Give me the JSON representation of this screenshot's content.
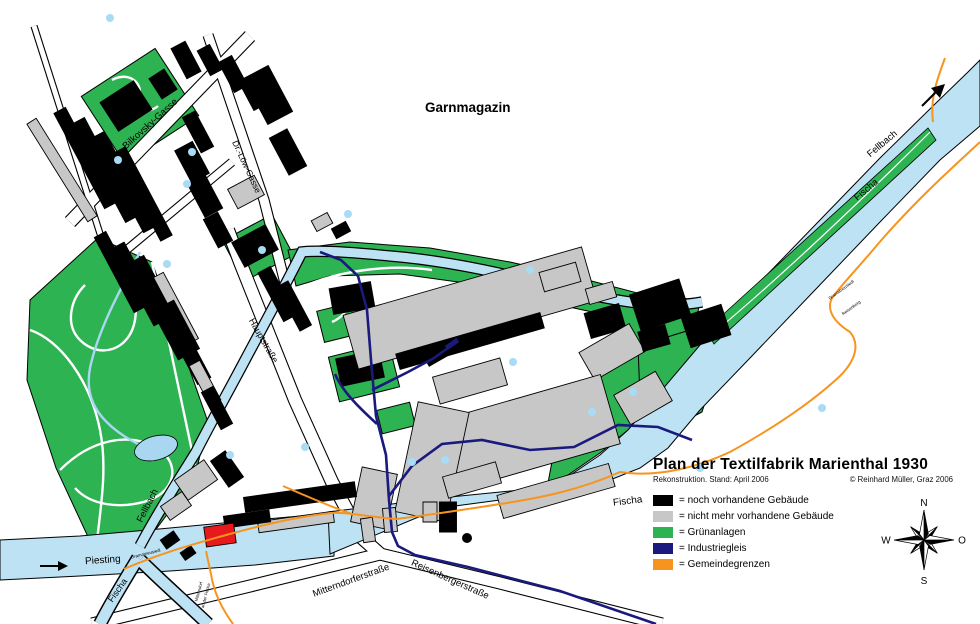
{
  "map": {
    "labels": {
      "garnmagazin": "Garnmagazin",
      "bilkovsky_gasse": "Bilkovsky-Gasse",
      "dr_loew_gasse": "Dr.-Löw-Gasse",
      "hauptstrasse": "Hauptstraße",
      "piesting": "Piesting",
      "fellbach_sw": "Fellbach",
      "fellbach_ne": "Fellbach",
      "fischa_sw": "Fischa",
      "fischa_mid": "Fischa",
      "fischa_ne": "Fischa",
      "mitterndorferstrasse": "Mitterndorferstraße",
      "reisenbergerstrasse": "Reisenbergerstraße",
      "boundary_gramatneusiedl_sw": "Gramatneusiedl",
      "boundary_gramatneusiedl_e": "Gramatneusiedl",
      "boundary_reisenberg_e": "Reisenberg",
      "boundary_mitterndorf_1": "Mitterndorf",
      "boundary_mitterndorf_2": "an der Fischa"
    },
    "colors": {
      "existing_building": "#000000",
      "demolished_building": "#C7C7C7",
      "green_area": "#2EB353",
      "industrial_rail": "#1A1A7E",
      "municipal_boundary": "#F7941D",
      "water": "#BCE2F4",
      "pond": "#A9D7F2",
      "water_dot": "#A8DCF5",
      "highlight_red": "#E8191C"
    }
  },
  "title_block": {
    "title": "Plan der Textilfabrik Marienthal 1930",
    "subtitle": "Rekonstruktion. Stand: April 2006",
    "copyright": "© Reinhard Müller, Graz 2006"
  },
  "legend": {
    "items": [
      {
        "label": "= noch vorhandene Gebäude",
        "color": "#000000"
      },
      {
        "label": "= nicht mehr vorhandene Gebäude",
        "color": "#C7C7C7"
      },
      {
        "label": "= Grünanlagen",
        "color": "#2EB353"
      },
      {
        "label": "= Industriegleis",
        "color": "#1A1A7E"
      },
      {
        "label": "= Gemeindegrenzen",
        "color": "#F7941D"
      }
    ]
  },
  "compass": {
    "north": "N",
    "east": "O",
    "south": "S",
    "west": "W"
  }
}
